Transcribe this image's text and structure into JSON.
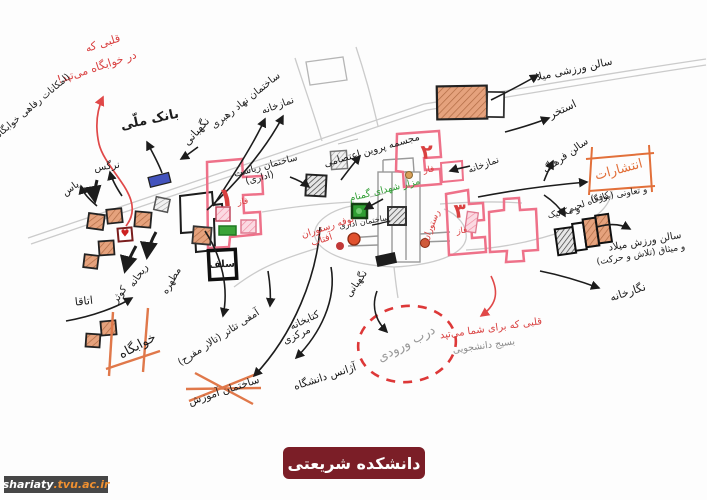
{
  "colors": {
    "ink": "#1c1c1c",
    "red_accent": "#d94040",
    "pink_building": "#ee7189",
    "orange_building": "#e5a27d",
    "green_marker": "#2f9e33",
    "blue_marker": "#4353bd",
    "road_gray": "#cbcbcb",
    "pencil_gray": "#9a9a9a",
    "banner_bg": "#7b1e27",
    "url_bg": "#464646",
    "url_orange": "#f09030"
  },
  "icons": {
    "heart": "♥"
  },
  "map_labels": {
    "heart_dorm_l1": "قلبی که",
    "heart_dorm_l2": "در خوابگاه می‌تپد!",
    "dorm_note": "(امکانات رفاهی خوابگاه)",
    "bank": "بانک ملّی",
    "guard_w": "نگهبانی",
    "narges": "نرگس",
    "yas": "یاس",
    "prayer_n": "نمازخانه",
    "nahad": "ساختمان نهاد رهبری",
    "parvin": "مجسمه پروین اعتصامی",
    "riasat_l1": "ساختمان ریاست",
    "riasat_l2": "(اداری)",
    "mazar": "مزار شهدای گمنام",
    "edari": "ساختمان اداری",
    "bufe_l1": "بوفه رستوران",
    "bufe_l2": "آفتاب",
    "rest_r": "رستوران",
    "faz": "فاز",
    "n1": "۱",
    "n2": "۲",
    "n3": "۳",
    "self": "سلف",
    "rooms": "اتاقا",
    "kosar": "کوثر",
    "reyhane": "ریحانه",
    "motahare": "مطهره",
    "dorm": "خوابگاه",
    "amphi": "آمفی تئاتر (تالار مفرح)",
    "education": "ساختمان آموزش",
    "library_l1": "کتابخانه",
    "library_l2": "مرکزی",
    "agency": "آژانس دانشگاه",
    "guard_gate": "نگهبانی",
    "entrance": "درب ورودی",
    "heart_you": "قلبی که برای شما می‌تپد",
    "basij": "بسیج دانشجویی",
    "prayer_e": "نمازخانه",
    "culture": "سالن فرهنگ",
    "pool": "استخر",
    "milad": "سالن ورزشی میلاد",
    "press": "انتشارات",
    "coop": "و تعاونی (بوفه)",
    "workshop_l1": "کارگاه لحیم",
    "workshop_l2": "و مکانیک",
    "sports_l1": "سالن ورزش میلاد",
    "sports_l2": "و میثاق (تلاش و حرکت)",
    "gallery": "نگارخانه"
  },
  "footer": {
    "banner": "دانشکده شریعتی",
    "url_main": "shariaty",
    "url_suffix": ".tvu.ac.ir"
  }
}
